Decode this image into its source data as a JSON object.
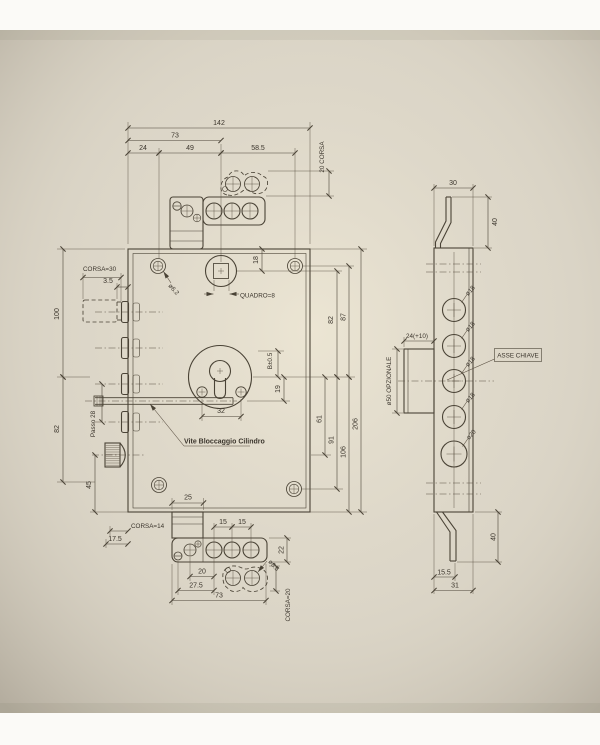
{
  "photo": {
    "paper_color": "#d9d3c5",
    "line_color": "#4a4336",
    "background": "#fbfaf7"
  },
  "front_view": {
    "top_dims": {
      "total_width": "142",
      "width_73": "73",
      "w24": "24",
      "w49": "49",
      "w58_5": "58.5",
      "corsa_20": "20 CORSA"
    },
    "right_dims": {
      "d18": "18",
      "d82": "82",
      "d87": "87",
      "d206": "206",
      "b_tol": "B±0.5",
      "d19": "19",
      "d61": "61",
      "d91": "91",
      "d106": "106"
    },
    "left_dims": {
      "corsa_30": "CORSA=30",
      "d3_5": "3.5",
      "d100": "100",
      "d82": "82",
      "passo_28": "Passo 28",
      "d45": "45",
      "corsa_14": "CORSA=14",
      "d17_5": "17.5"
    },
    "bottom_dims": {
      "d25": "25",
      "d15_a": "15",
      "d15_b": "15",
      "d20": "20",
      "d27_5": "27.5",
      "d73": "73",
      "d22": "22",
      "phi_6_5": "ø6.5",
      "corsa_20": "CORSA=20"
    },
    "labels": {
      "quadro": "QUADRO=8",
      "phi_6_2": "ø6.2",
      "d32": "32",
      "vite_bloccaggio": "Vite Bloccaggio Cilindro"
    }
  },
  "side_view": {
    "dims": {
      "d30": "30",
      "d40_top": "40",
      "d24_plus10": "24(+10)",
      "d15_5": "15.5",
      "d31": "31",
      "d40_bottom": "40"
    },
    "labels": {
      "phi50_opzionale": "ø50 OPZIONALE",
      "asse_chiave": "ASSE CHIAVE",
      "phi18_1": "ø18",
      "phi18_2": "ø18",
      "phi18_3": "ø18",
      "phi18_4": "ø18",
      "phi20": "ø20"
    }
  }
}
